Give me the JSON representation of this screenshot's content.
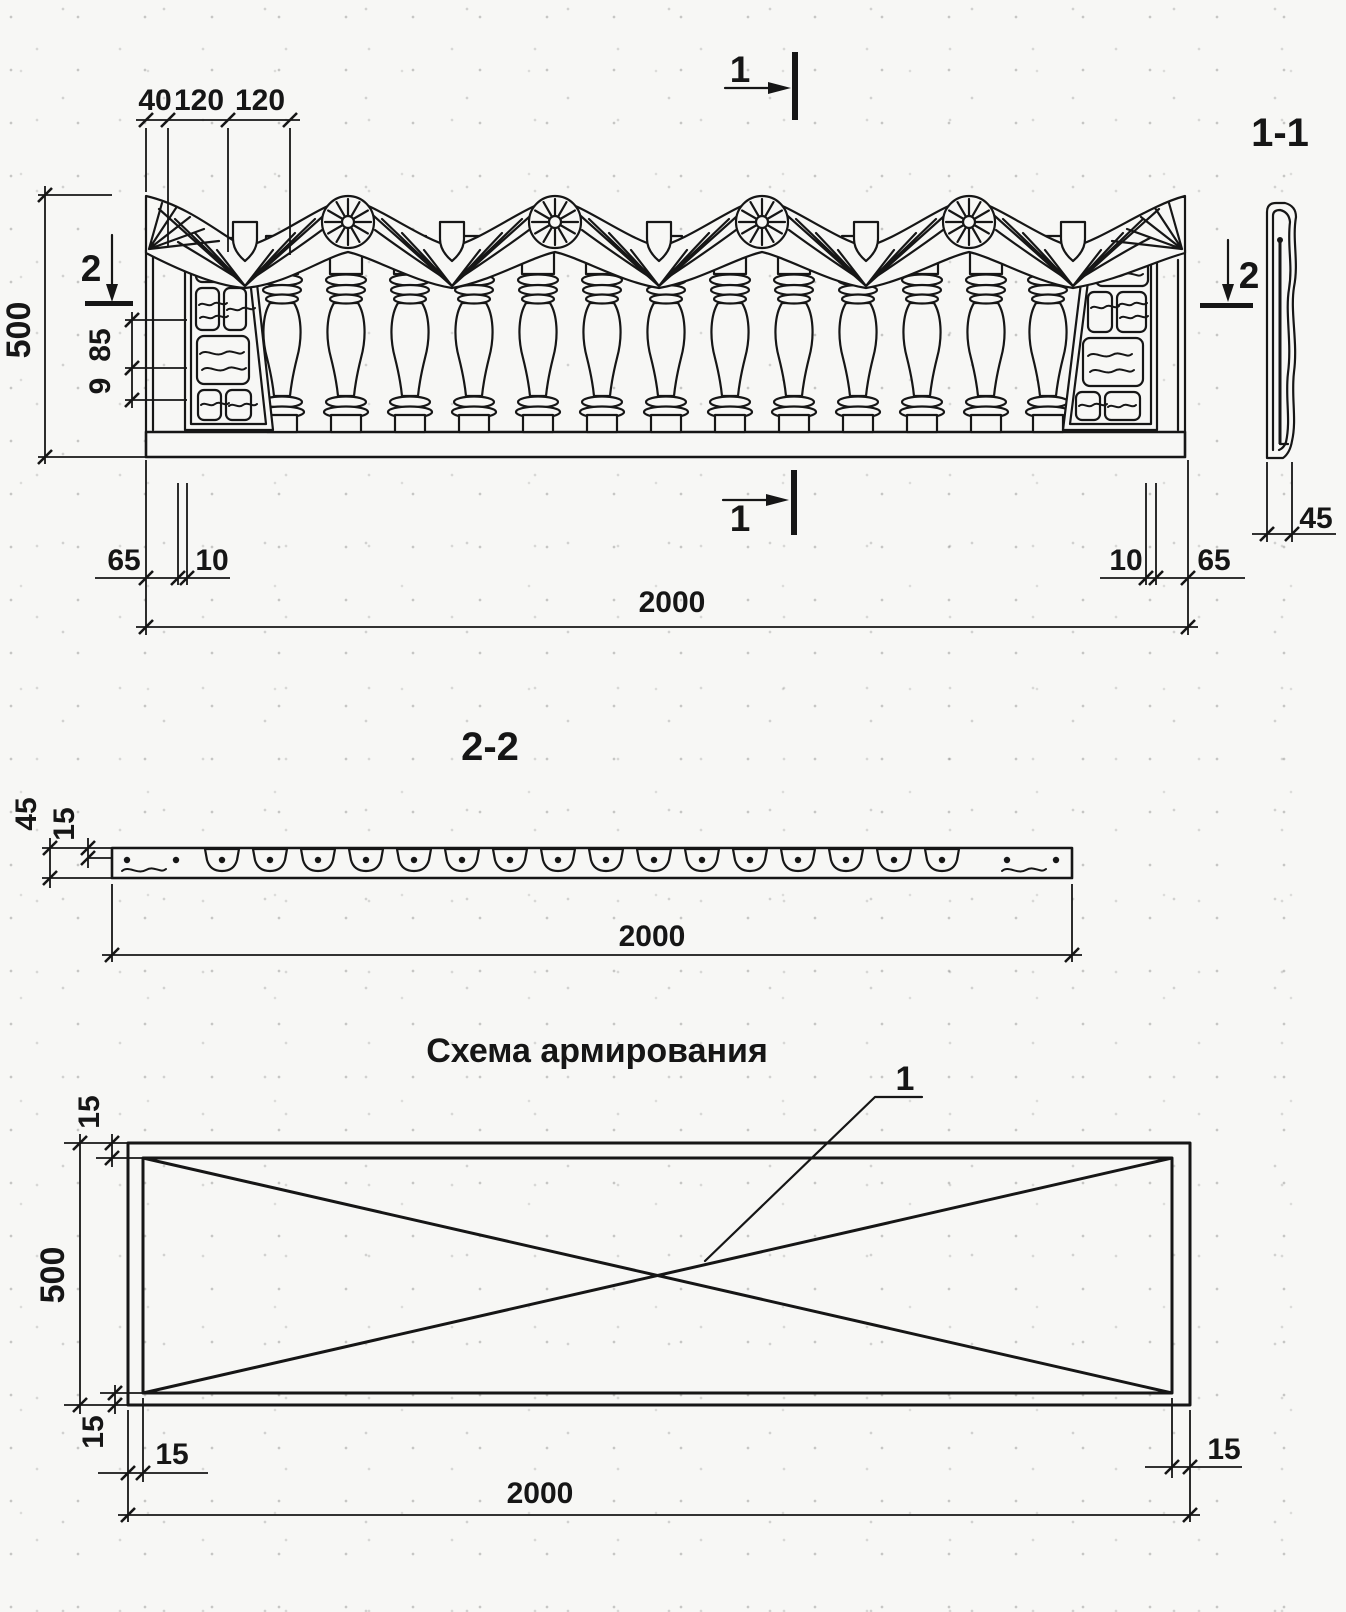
{
  "front_view": {
    "cut1_top": "1",
    "cut1_bottom": "1",
    "cut2_left": "2",
    "cut2_right": "2",
    "dim_40": "40",
    "dim_120a": "120",
    "dim_120b": "120",
    "dim_500": "500",
    "dim_85": "85",
    "dim_9": "9",
    "dim_65_left": "65",
    "dim_10_left": "10",
    "dim_10_right": "10",
    "dim_65_right": "65",
    "dim_2000": "2000",
    "section_11": {
      "label": "1-1",
      "dim_45": "45"
    }
  },
  "section_22": {
    "label": "2-2",
    "dim_45": "45",
    "dim_15": "15",
    "dim_2000": "2000"
  },
  "reinforcement": {
    "title": "Схема армирования",
    "callout_1": "1",
    "dim_15_top": "15",
    "dim_500": "500",
    "dim_15_bottom": "15",
    "dim_15_left": "15",
    "dim_2000": "2000",
    "dim_15_right": "15"
  }
}
